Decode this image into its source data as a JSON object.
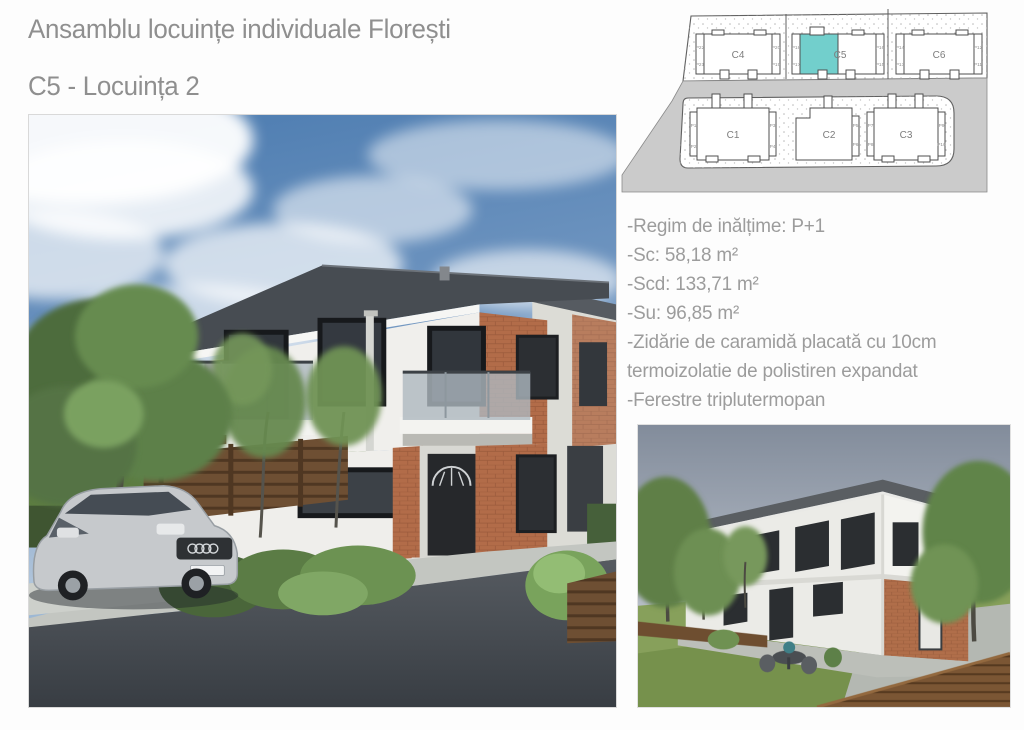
{
  "page": {
    "title": "Ansamblu locuințe individuale Florești",
    "subtitle": "C5 - Locuința 2"
  },
  "site_plan": {
    "highlighted_unit": "C5",
    "highlight_color": "#72cfcc",
    "top_row": [
      {
        "label": "C4",
        "parcels_left": [
          "P22",
          "P21"
        ],
        "parcels_right": [
          "P20",
          "P19"
        ]
      },
      {
        "label": "C5",
        "parcels_left": [
          "P18",
          "P17"
        ],
        "parcels_right": [
          "P16",
          "P15"
        ]
      },
      {
        "label": "C6",
        "parcels_left": [
          "P14",
          "P13"
        ],
        "parcels_right": [
          "P12",
          "P11"
        ]
      }
    ],
    "bottom_row": [
      {
        "label": "C1",
        "parcels_left": [
          "P1",
          "P2"
        ],
        "parcels_right": [
          "P3",
          "P4"
        ]
      },
      {
        "label": "C2",
        "parcels_left": [],
        "parcels_right": [
          "P5",
          "P6"
        ]
      },
      {
        "label": "C3",
        "parcels_left": [
          "P7",
          "P8"
        ],
        "parcels_right": [
          "P9",
          "P10"
        ]
      }
    ]
  },
  "details": {
    "lines": [
      "-Regim de inălțime: P+1",
      "-Sc: 58,18 m²",
      "-Scd: 133,71 m²",
      "-Su: 96,85 m²",
      "-Zidărie de caramidă placată cu 10cm termoizolatie de polistiren expandat",
      "-Ferestre triplutermopan"
    ]
  },
  "colors": {
    "title_text": "#8f8f8f",
    "details_text": "#9c9c9c",
    "plan_road": "#cbcbcb",
    "brick": "#b26c49",
    "roof": "#474c52",
    "sky": "#4b7bb0",
    "asphalt": "#3e434a"
  }
}
